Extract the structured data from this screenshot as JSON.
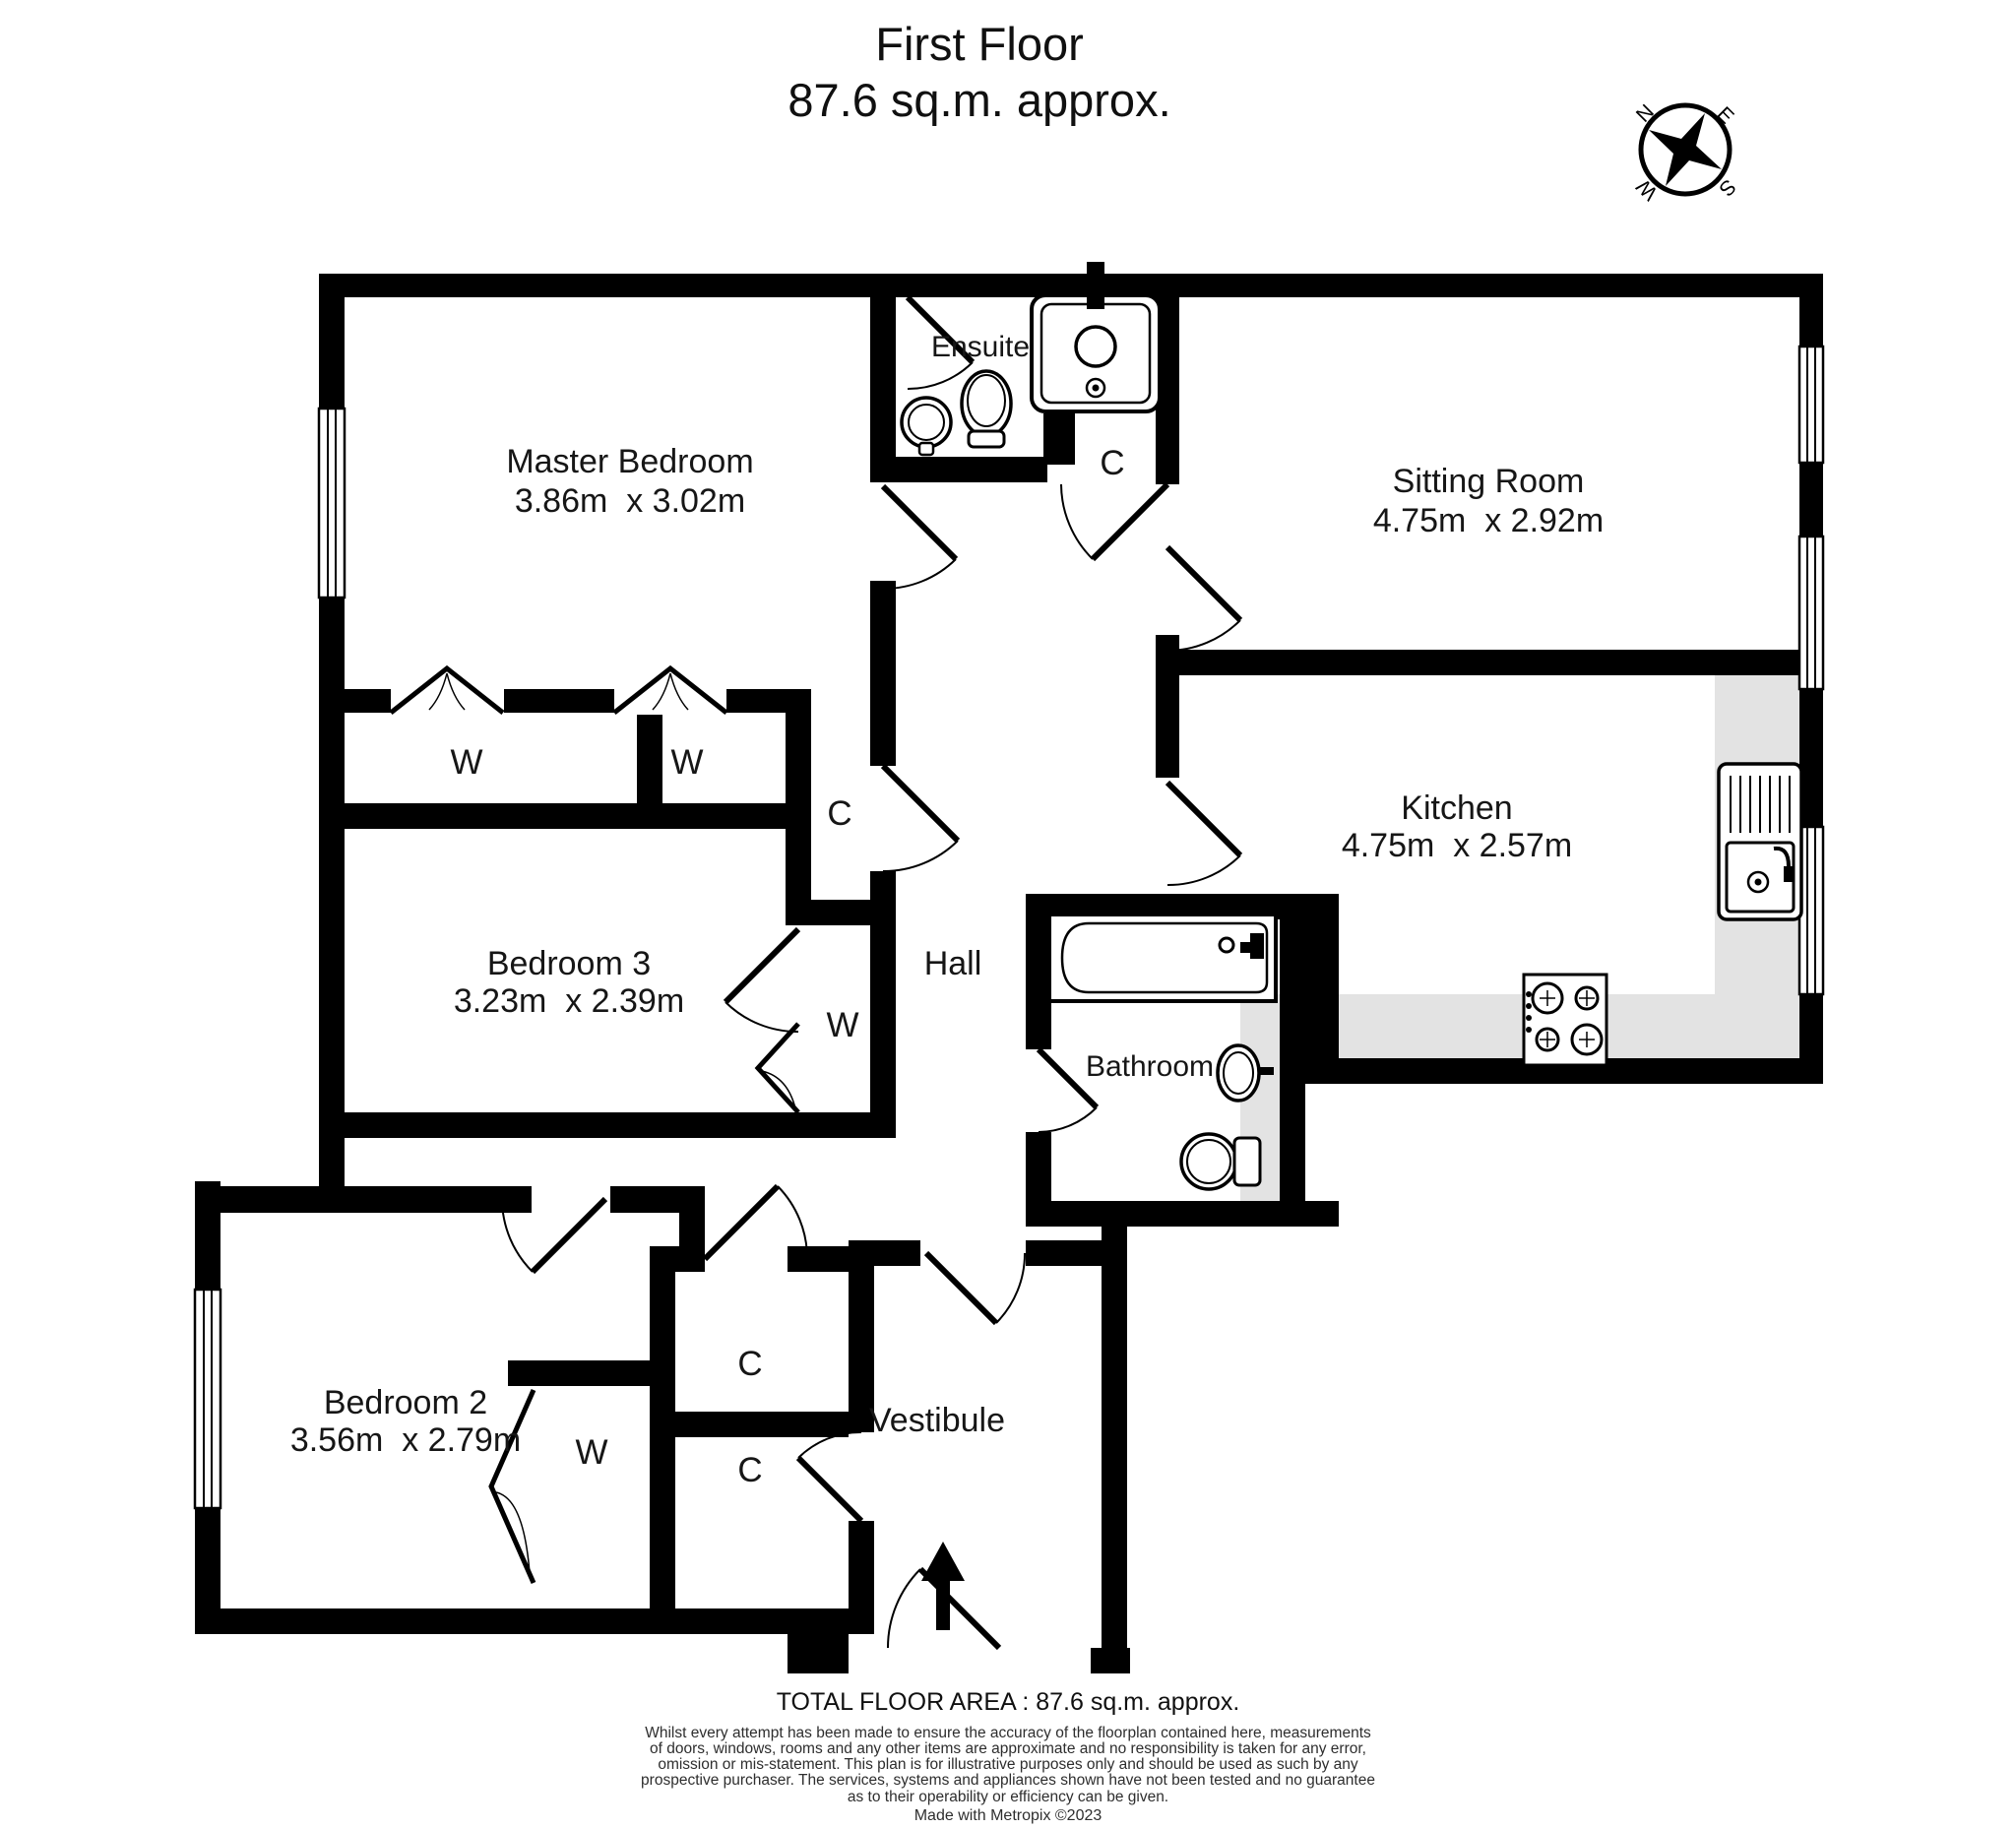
{
  "title": {
    "line1": "First Floor",
    "line2": "87.6 sq.m. approx."
  },
  "compass": {
    "north": "N",
    "east": "E",
    "south": "S",
    "west": "W"
  },
  "rooms": {
    "master_bedroom": {
      "name": "Master Bedroom",
      "dims": "3.86m  x 3.02m"
    },
    "ensuite": {
      "name": "Ensuite"
    },
    "sitting_room": {
      "name": "Sitting Room",
      "dims": "4.75m  x 2.92m"
    },
    "kitchen": {
      "name": "Kitchen",
      "dims": "4.75m  x 2.57m"
    },
    "bedroom3": {
      "name": "Bedroom 3",
      "dims": "3.23m  x 2.39m"
    },
    "hall": {
      "name": "Hall"
    },
    "bathroom": {
      "name": "Bathroom"
    },
    "bedroom2": {
      "name": "Bedroom 2",
      "dims": "3.56m  x 2.79m"
    },
    "vestibule": {
      "name": "Vestibule"
    }
  },
  "labels": {
    "wardrobe": "W",
    "cupboard": "C"
  },
  "footer": {
    "total": "TOTAL FLOOR AREA : 87.6 sq.m. approx.",
    "disclaimer": "Whilst every attempt has been made to ensure the accuracy of the floorplan contained here, measurements\nof doors, windows, rooms and any other items are approximate and no responsibility is taken for any error,\nomission or mis-statement. This plan is for illustrative purposes only and should be used as such by any\nprospective purchaser. The services, systems and appliances shown have not been tested and no guarantee\nas to their operability or efficiency can be given.",
    "credit": "Made with Metropix ©2023"
  },
  "colors": {
    "wall": "#000000",
    "counter": "#e3e3e3",
    "text": "#161616"
  }
}
